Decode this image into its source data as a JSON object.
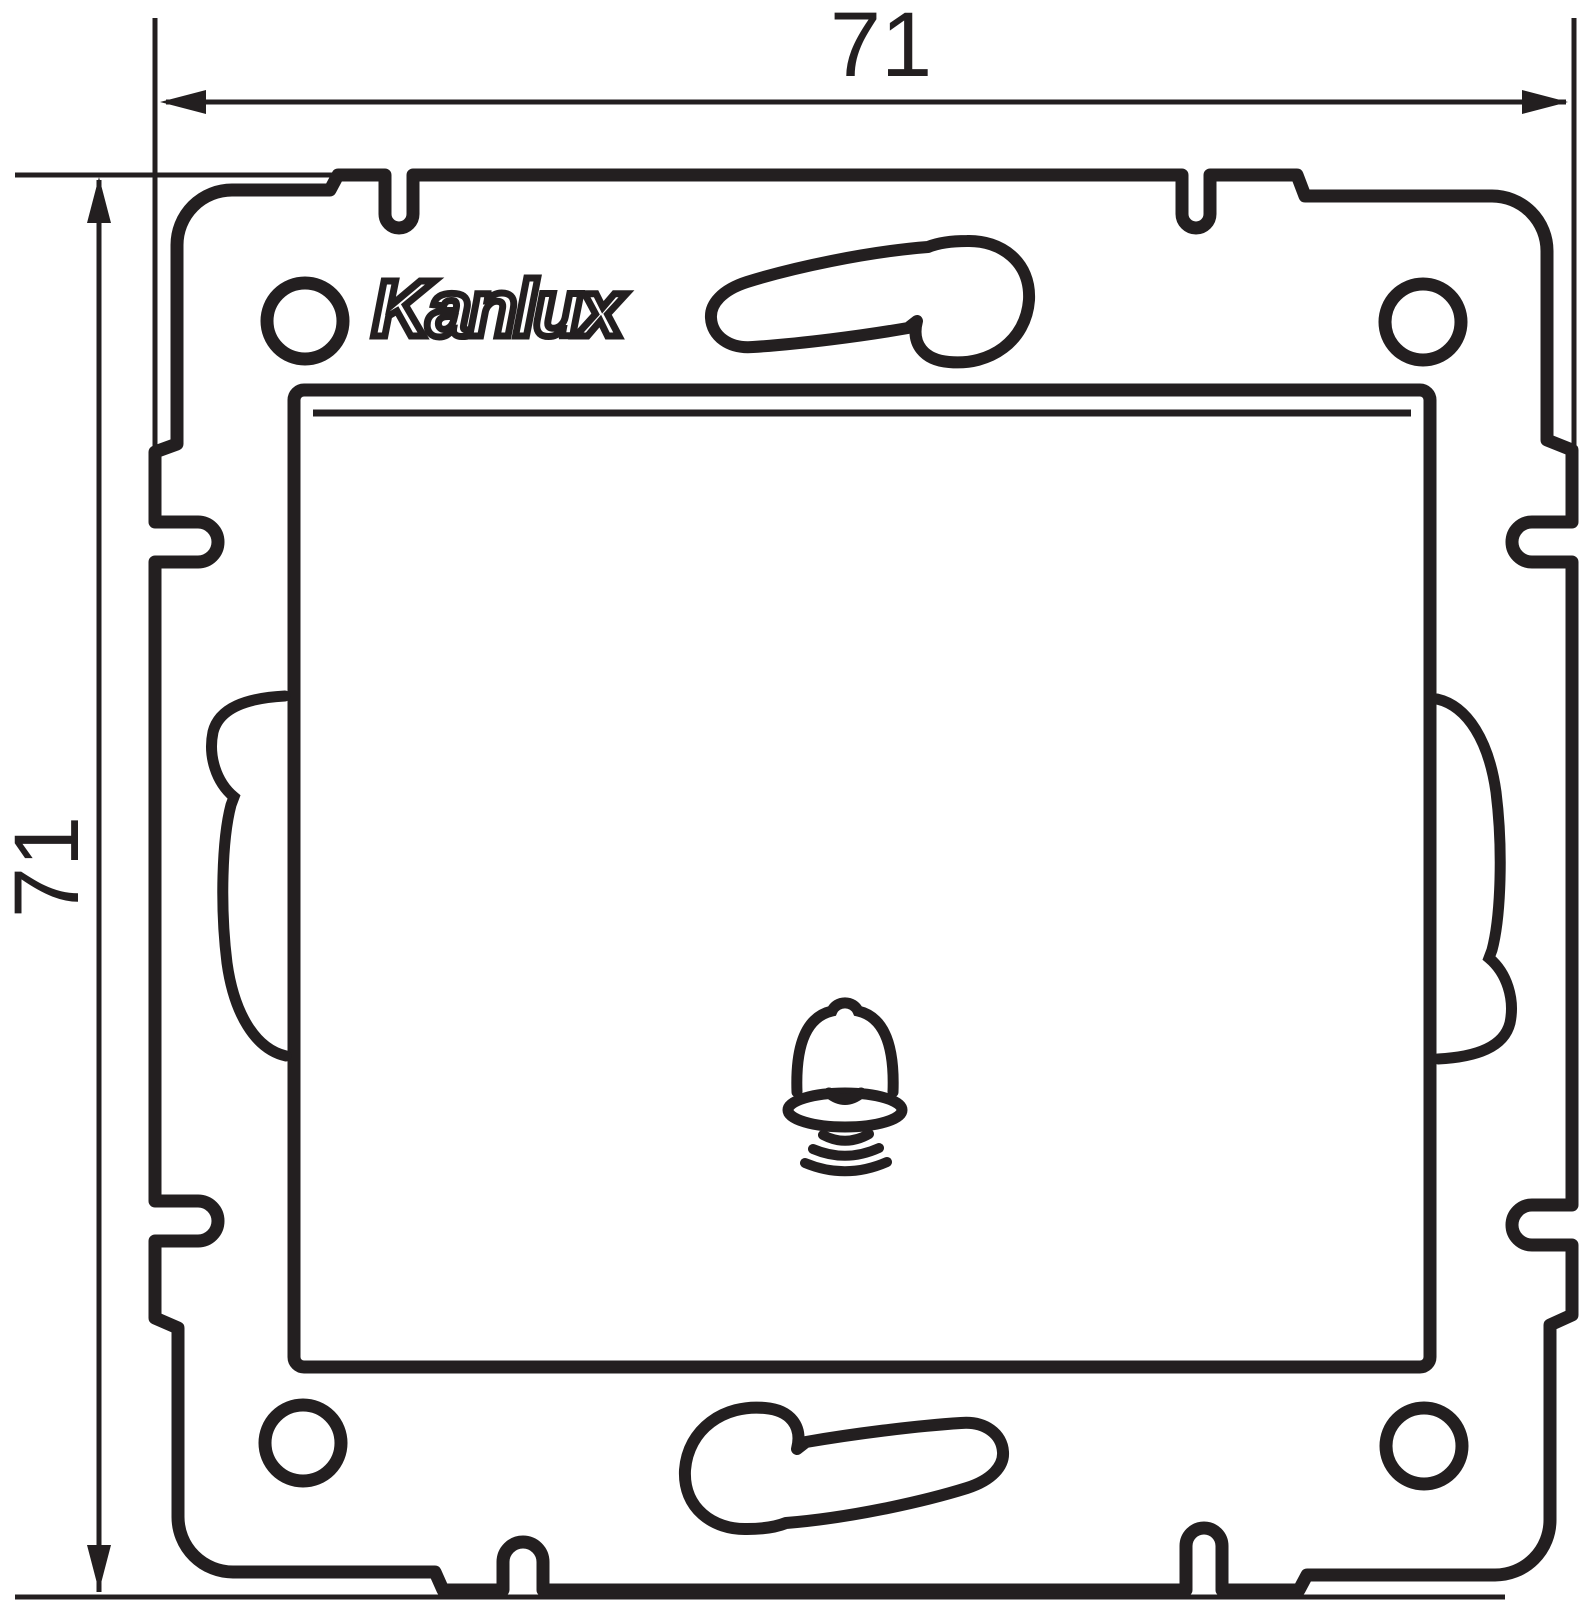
{
  "page": {
    "background": "#ffffff",
    "ink": "#231f20"
  },
  "drawing": {
    "type": "technical dimension drawing",
    "view": "front view of a square wall-switch mounting frame with central push button",
    "symbol_on_button": "bell-icon"
  },
  "dimension_top": {
    "value": "71"
  },
  "dimension_left": {
    "value": "71"
  },
  "logo": {
    "text": "Kanlux"
  }
}
